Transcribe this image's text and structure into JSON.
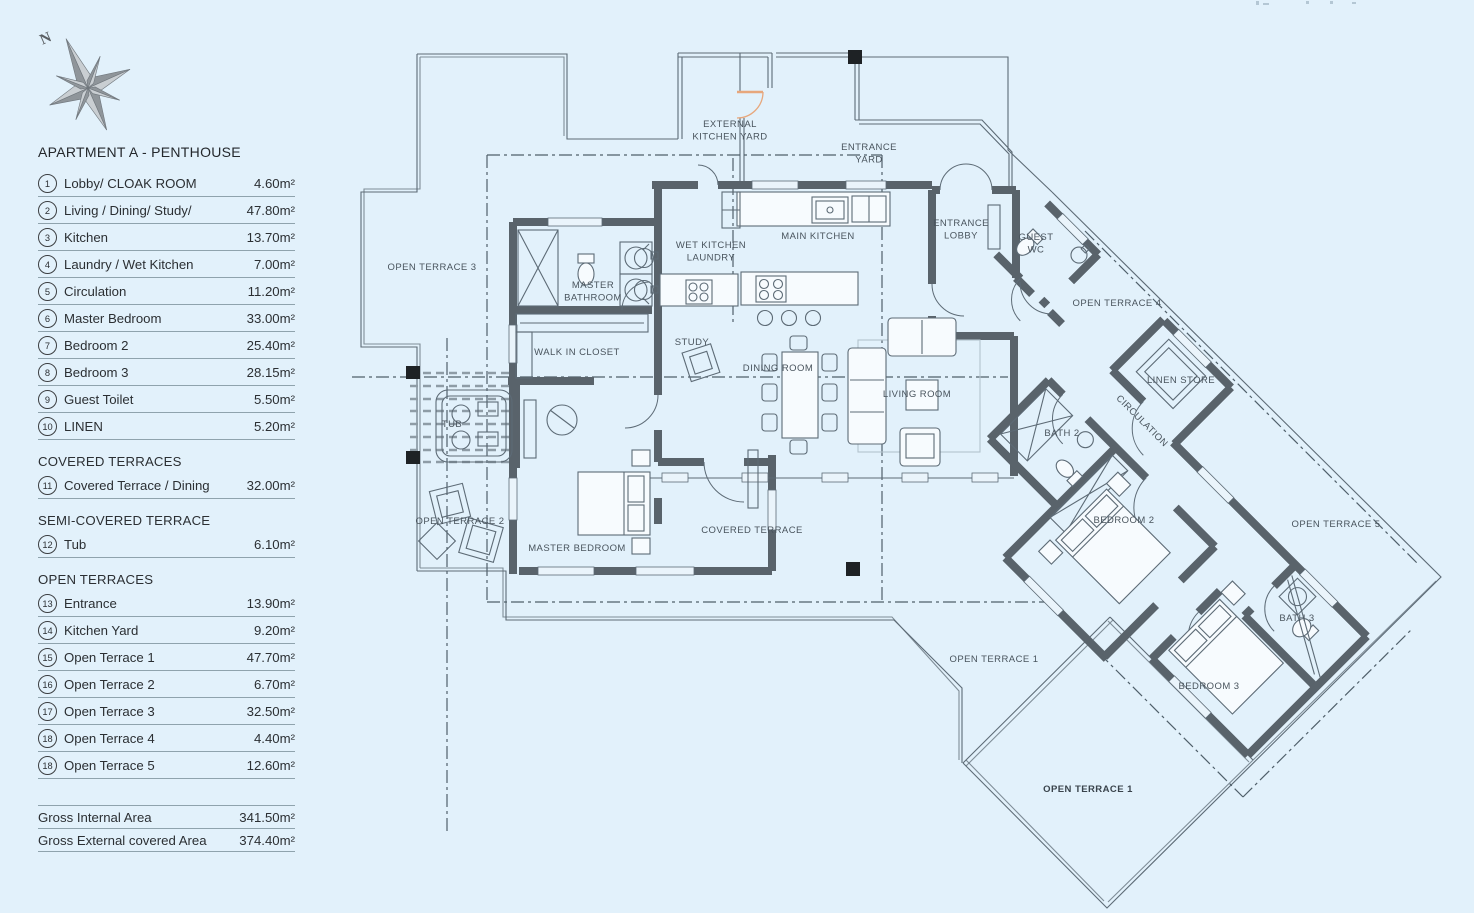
{
  "compass": {
    "label": "N"
  },
  "legend": {
    "title": "APARTMENT A - PENTHOUSE",
    "sections": [
      {
        "header": "",
        "items": [
          {
            "num": "1",
            "label": "Lobby/ CLOAK ROOM",
            "area": "4.60m²"
          },
          {
            "num": "2",
            "label": "Living / Dining/ Study/",
            "area": "47.80m²"
          },
          {
            "num": "3",
            "label": "Kitchen",
            "area": "13.70m²"
          },
          {
            "num": "4",
            "label": "Laundry / Wet Kitchen",
            "area": "7.00m²"
          },
          {
            "num": "5",
            "label": "Circulation",
            "area": "11.20m²"
          },
          {
            "num": "6",
            "label": "Master Bedroom",
            "area": "33.00m²"
          },
          {
            "num": "7",
            "label": "Bedroom 2",
            "area": "25.40m²"
          },
          {
            "num": "8",
            "label": "Bedroom 3",
            "area": "28.15m²"
          },
          {
            "num": "9",
            "label": "Guest Toilet",
            "area": "5.50m²"
          },
          {
            "num": "10",
            "label": "LINEN",
            "area": "5.20m²"
          }
        ]
      },
      {
        "header": "COVERED TERRACES",
        "items": [
          {
            "num": "11",
            "label": "Covered Terrace / Dining",
            "area": "32.00m²"
          }
        ]
      },
      {
        "header": "SEMI-COVERED TERRACE",
        "items": [
          {
            "num": "12",
            "label": "Tub",
            "area": "6.10m²"
          }
        ]
      },
      {
        "header": "OPEN TERRACES",
        "items": [
          {
            "num": "13",
            "label": "Entrance",
            "area": "13.90m²"
          },
          {
            "num": "14",
            "label": "Kitchen Yard",
            "area": "9.20m²"
          },
          {
            "num": "15",
            "label": "Open Terrace 1",
            "area": "47.70m²"
          },
          {
            "num": "16",
            "label": "Open Terrace 2",
            "area": "6.70m²"
          },
          {
            "num": "17",
            "label": "Open Terrace 3",
            "area": "32.50m²"
          },
          {
            "num": "18",
            "label": "Open Terrace 4",
            "area": "4.40m²"
          },
          {
            "num": "18",
            "label": "Open Terrace 5",
            "area": "12.60m²"
          }
        ]
      }
    ],
    "totals": [
      {
        "label": "Gross Internal Area",
        "area": "341.50m²"
      },
      {
        "label": "Gross External covered Area",
        "area": "374.40m²"
      }
    ]
  },
  "plan": {
    "labels": [
      {
        "text": "EXTERNAL\nKITCHEN YARD",
        "x": 730,
        "y": 127
      },
      {
        "text": "ENTRANCE\nYARD",
        "x": 869,
        "y": 150
      },
      {
        "text": "MAIN KITCHEN",
        "x": 818,
        "y": 239
      },
      {
        "text": "WET KITCHEN\nLAUNDRY",
        "x": 711,
        "y": 248
      },
      {
        "text": "ENTRANCE\nLOBBY",
        "x": 961,
        "y": 226
      },
      {
        "text": "GUEST\nWC",
        "x": 1036,
        "y": 240
      },
      {
        "text": "OPEN TERRACE 4",
        "x": 1117,
        "y": 306
      },
      {
        "text": "LINEN STORE",
        "x": 1181,
        "y": 383
      },
      {
        "text": "CIRCULATION",
        "x": 1140,
        "y": 423,
        "rotate": 45
      },
      {
        "text": "OPEN TERRACE 3",
        "x": 432,
        "y": 270
      },
      {
        "text": "MASTER\nBATHROOM",
        "x": 593,
        "y": 288
      },
      {
        "text": "WALK IN CLOSET",
        "x": 577,
        "y": 355
      },
      {
        "text": "STUDY",
        "x": 692,
        "y": 345
      },
      {
        "text": "DINING ROOM",
        "x": 778,
        "y": 371
      },
      {
        "text": "LIVING ROOM",
        "x": 917,
        "y": 397
      },
      {
        "text": "BATH 2",
        "x": 1062,
        "y": 436
      },
      {
        "text": "TUB",
        "x": 452,
        "y": 427,
        "size": 8
      },
      {
        "text": "MASTER BEDROOM",
        "x": 577,
        "y": 551
      },
      {
        "text": "COVERED TERRACE",
        "x": 752,
        "y": 533
      },
      {
        "text": "OPEN TERRACE 2",
        "x": 460,
        "y": 524
      },
      {
        "text": "BEDROOM 2",
        "x": 1124,
        "y": 523
      },
      {
        "text": "OPEN TERRACE 5",
        "x": 1336,
        "y": 527
      },
      {
        "text": "BATH 3",
        "x": 1297,
        "y": 621
      },
      {
        "text": "BEDROOM 3",
        "x": 1209,
        "y": 689
      },
      {
        "text": "OPEN TERRACE 1",
        "x": 994,
        "y": 662
      },
      {
        "text": "OPEN TERRACE 1",
        "x": 1088,
        "y": 792,
        "bold": true
      }
    ]
  }
}
